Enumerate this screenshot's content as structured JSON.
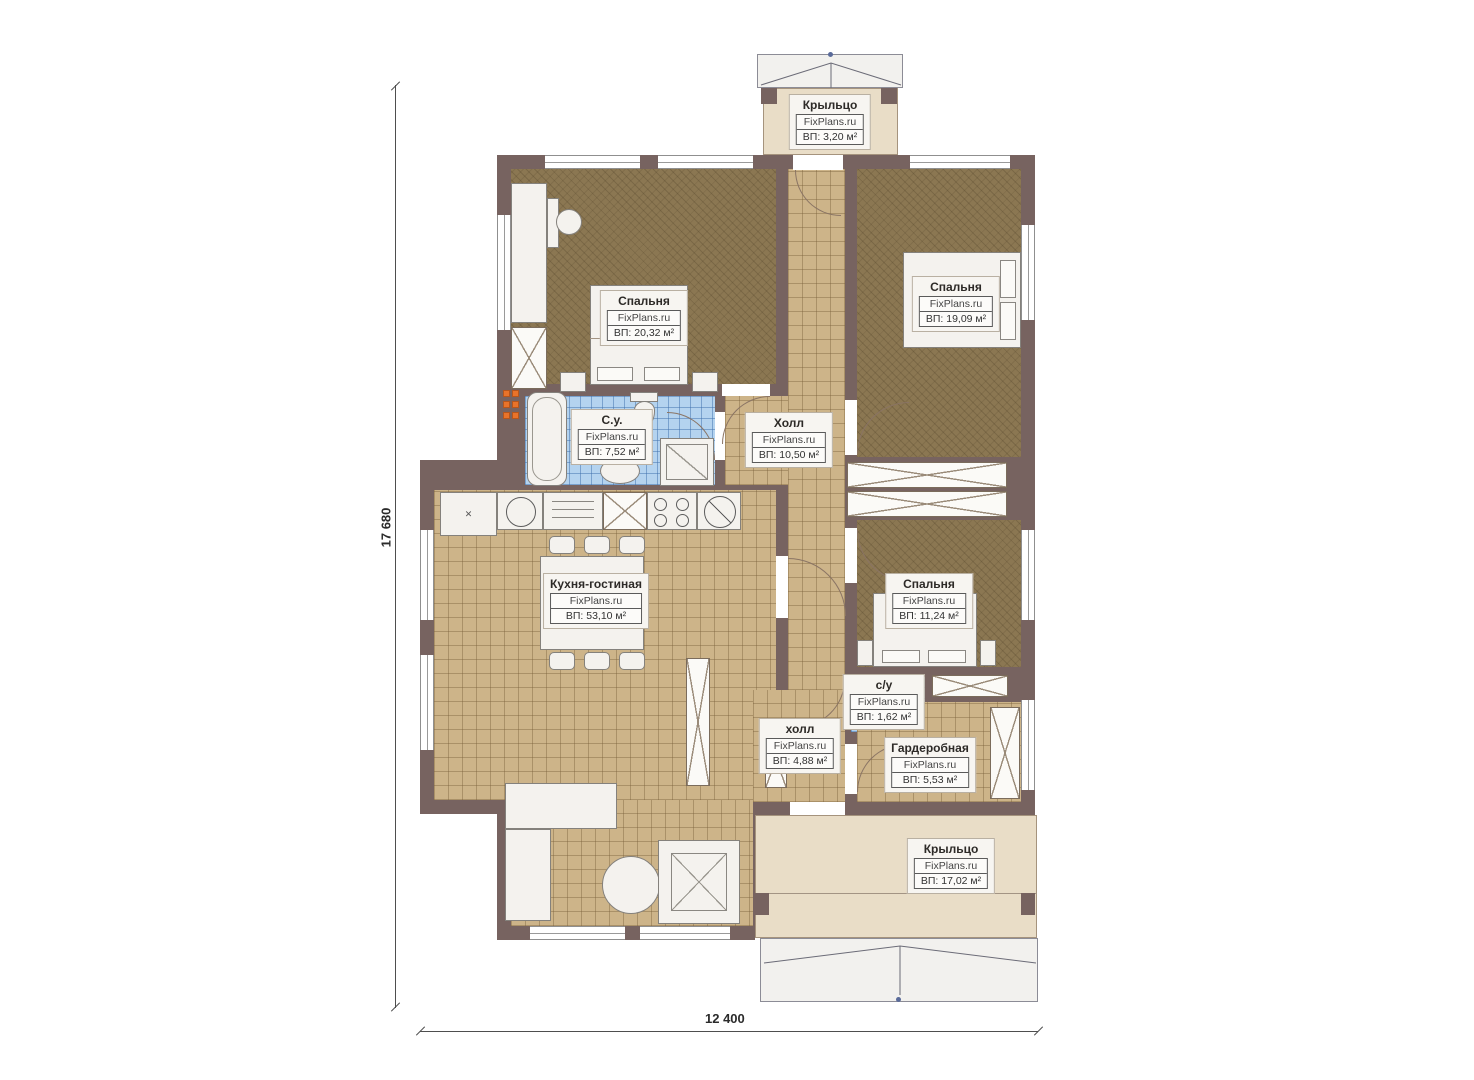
{
  "brand": "FixPlans.ru",
  "dimensions": {
    "height_label": "17 680",
    "width_label": "12 400"
  },
  "rooms": [
    {
      "id": "porch-top",
      "name": "Крыльцо",
      "brand": "FixPlans.ru",
      "area": "ВП: 3,20 м²"
    },
    {
      "id": "bedroom-1",
      "name": "Спальня",
      "brand": "FixPlans.ru",
      "area": "ВП: 20,32 м²"
    },
    {
      "id": "bedroom-2",
      "name": "Спальня",
      "brand": "FixPlans.ru",
      "area": "ВП: 19,09 м²"
    },
    {
      "id": "bathroom",
      "name": "С.у.",
      "brand": "FixPlans.ru",
      "area": "ВП: 7,52 м²"
    },
    {
      "id": "hall",
      "name": "Холл",
      "brand": "FixPlans.ru",
      "area": "ВП: 10,50 м²"
    },
    {
      "id": "kitchen-living",
      "name": "Кухня-гостиная",
      "brand": "FixPlans.ru",
      "area": "ВП: 53,10 м²"
    },
    {
      "id": "bedroom-3",
      "name": "Спальня",
      "brand": "FixPlans.ru",
      "area": "ВП: 11,24 м²"
    },
    {
      "id": "wc",
      "name": "с/у",
      "brand": "FixPlans.ru",
      "area": "ВП: 1,62 м²"
    },
    {
      "id": "hall-lower",
      "name": "холл",
      "brand": "FixPlans.ru",
      "area": "ВП: 4,88 м²"
    },
    {
      "id": "wardrobe",
      "name": "Гардеробная",
      "brand": "FixPlans.ru",
      "area": "ВП: 5,53 м²"
    },
    {
      "id": "porch-bottom",
      "name": "Крыльцо",
      "brand": "FixPlans.ru",
      "area": "ВП: 17,02 м²"
    }
  ],
  "colors": {
    "wall": "#776360",
    "bedroom_floor": "#8b7752",
    "tile_floor": "#cdb489",
    "bath_floor": "#b4d3ef",
    "porch_floor": "#e9ddc7",
    "radiator": "#e8732a"
  }
}
